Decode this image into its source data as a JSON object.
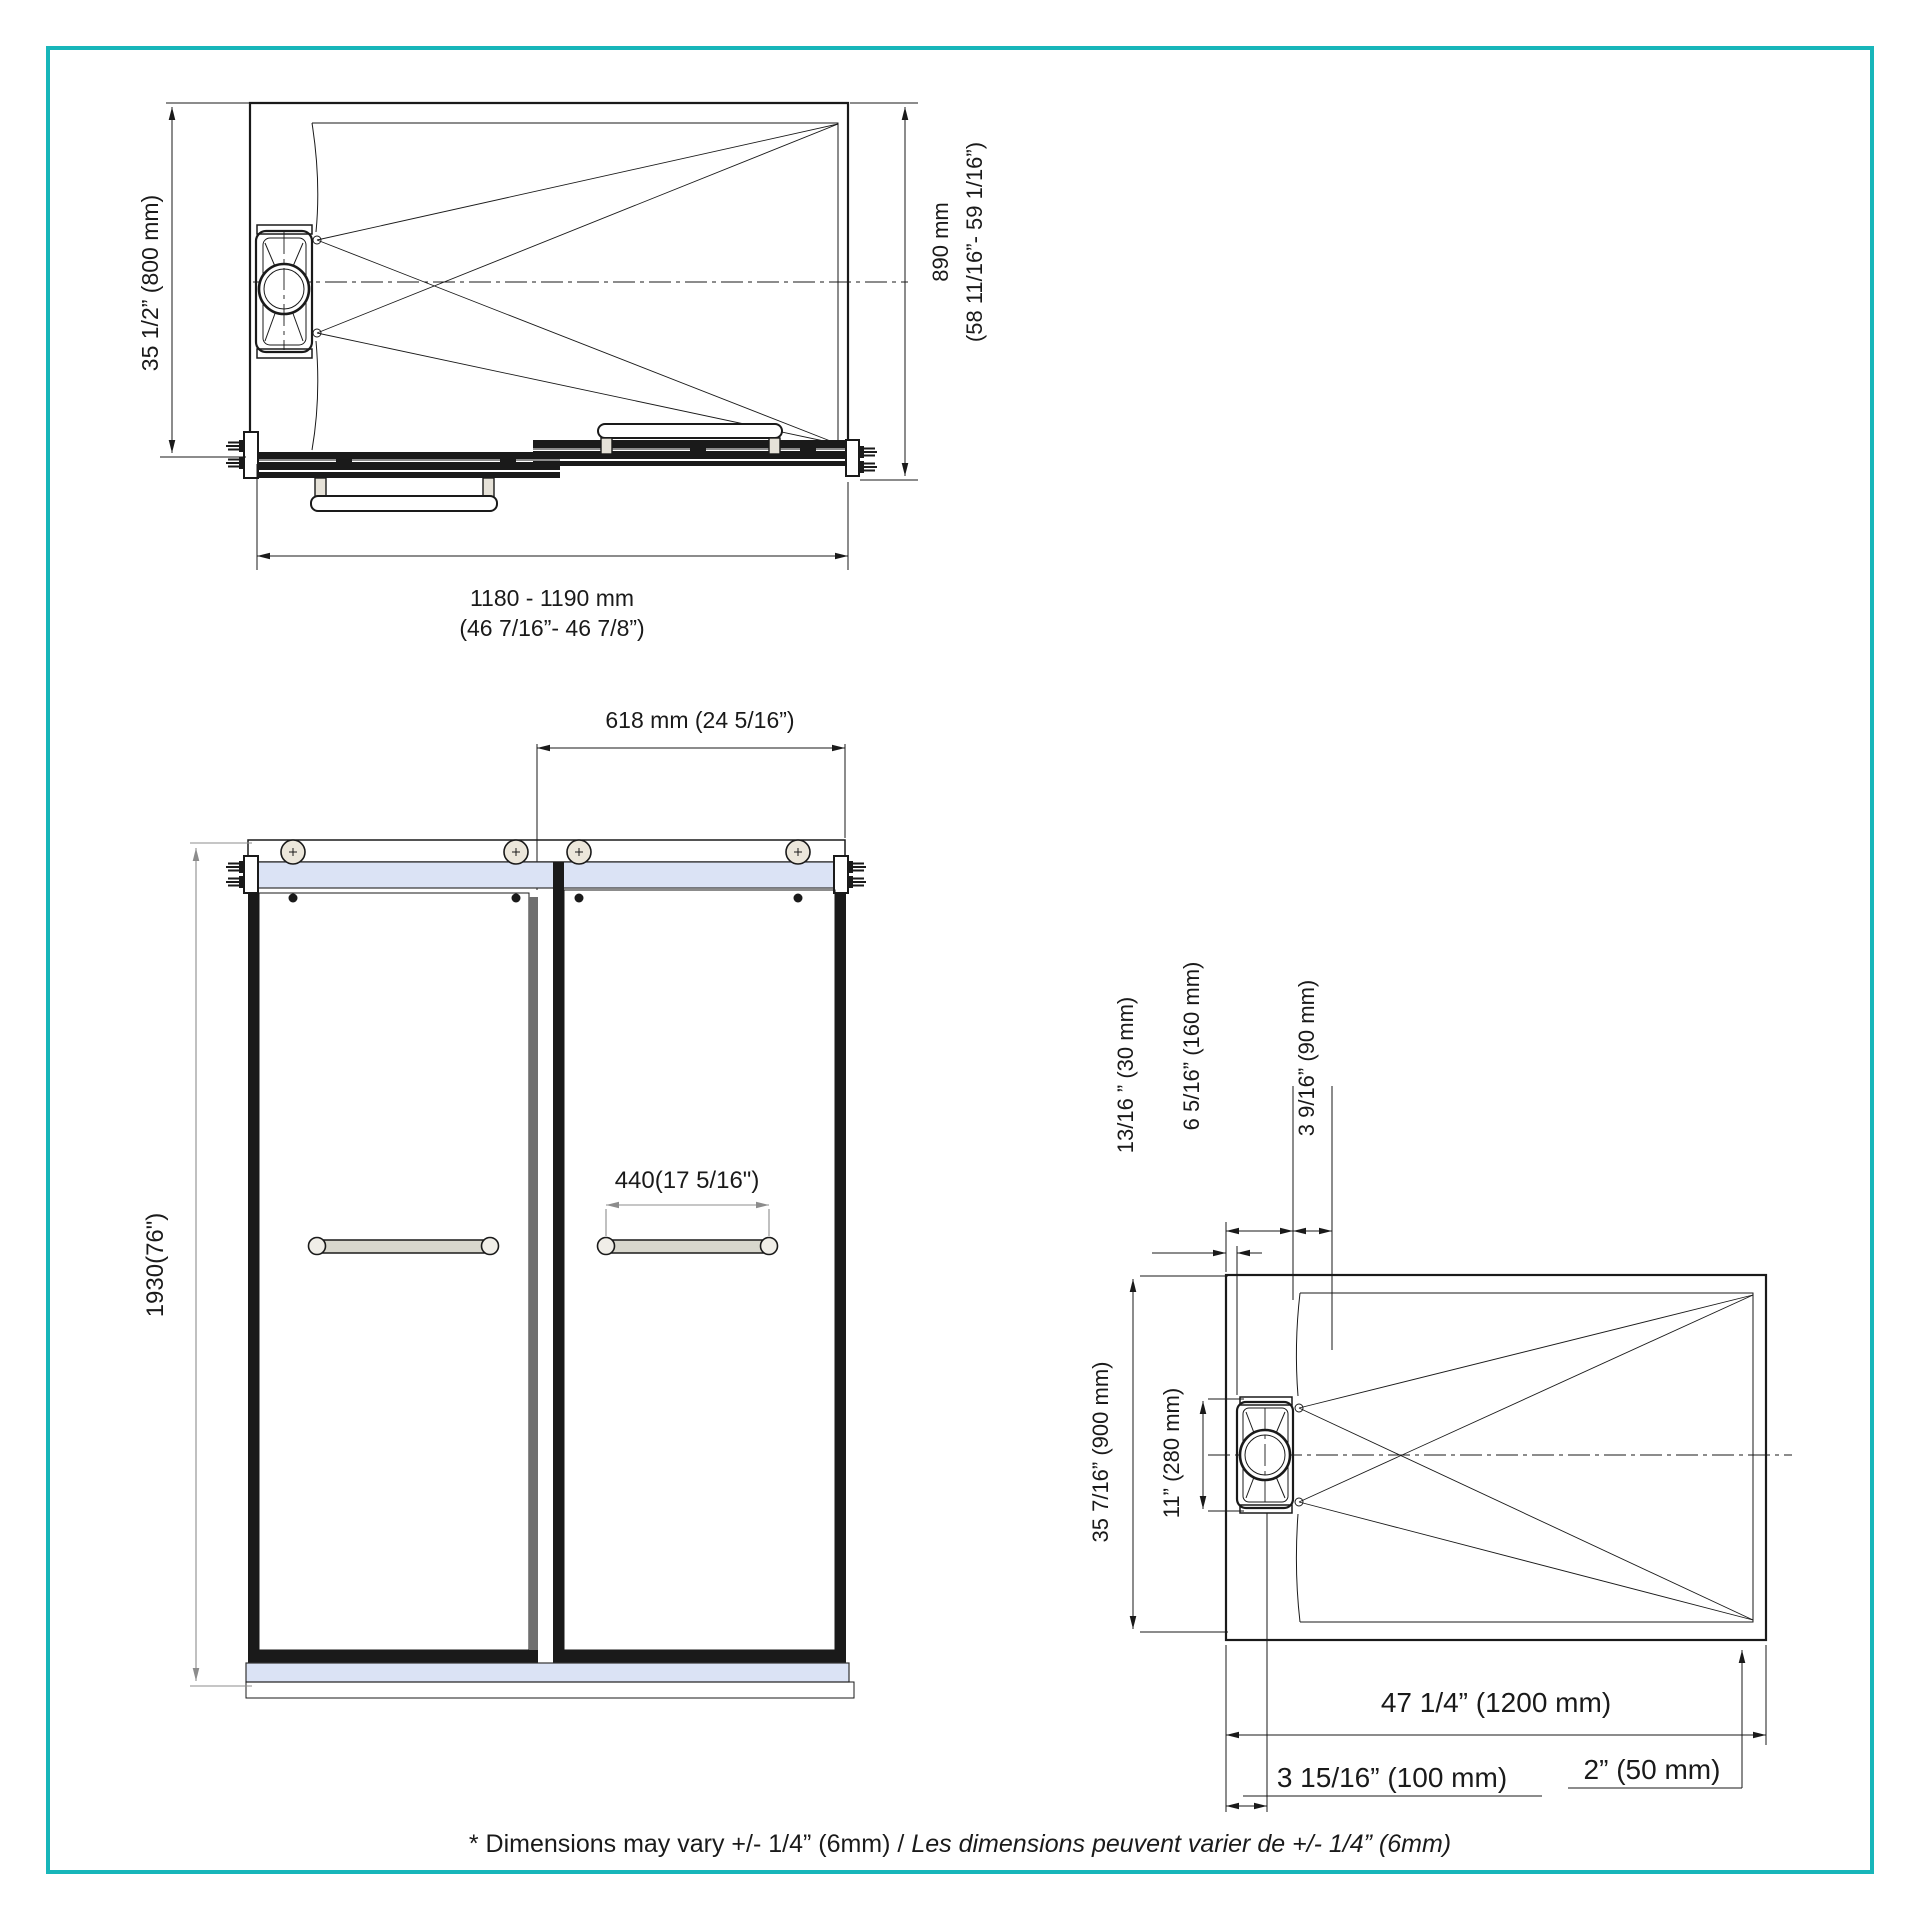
{
  "colors": {
    "border": "#18b6ba",
    "line": "#1a1a1a",
    "dim_gray": "#8c8c8c",
    "glass": "#dbe3f5",
    "handle_bar": "#d8d7cd",
    "roller": "#ece7db",
    "stile_gray": "#6f6f6f"
  },
  "top_view": {
    "dim_left": "35 1/2” (800 mm)",
    "dim_right_line1": "890 mm",
    "dim_right_line2": "(58 11/16”- 59 1/16”)",
    "dim_bottom_line1": "1180 - 1190 mm",
    "dim_bottom_line2": "(46 7/16”- 46 7/8”)"
  },
  "front_view": {
    "dim_top": "618 mm (24 5/16”)",
    "dim_handle": "440(17 5/16\")",
    "dim_height": "1930(76\")"
  },
  "base_view": {
    "dim_height": "35 7/16” (900 mm)",
    "dim_drain": "11” (280 mm)",
    "dim_offset_30": "13/16 ” (30 mm)",
    "dim_offset_160": "6 5/16” (160 mm)",
    "dim_offset_90": "3 9/16” (90 mm)",
    "dim_width": "47 1/4” (1200 mm)",
    "dim_drain_x": "3 15/16” (100 mm)",
    "dim_edge": "2” (50 mm)"
  },
  "footer": {
    "note_en": "* Dimensions may vary +/- 1/4” (6mm) / ",
    "note_fr": "Les dimensions peuvent varier de +/- 1/4” (6mm)"
  }
}
